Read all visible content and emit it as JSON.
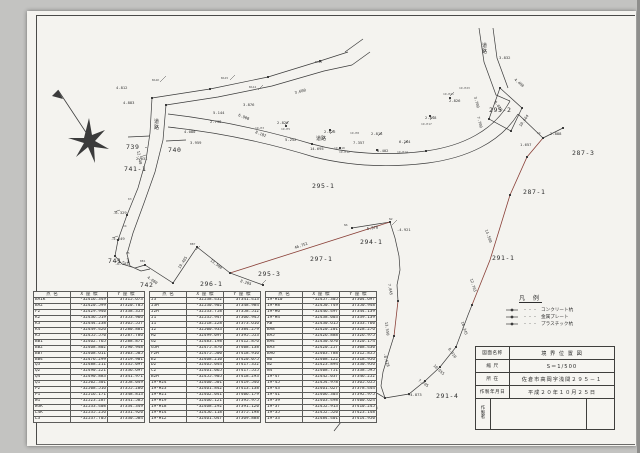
{
  "document": {
    "type": "scanned-survey-drawing",
    "colors": {
      "paper": "#f4f3ef",
      "line": "#3b3b3b",
      "red_boundary": "#8a4038",
      "scan_background": "#c3c3c1"
    }
  },
  "title_block": {
    "rows": [
      {
        "label": "図面名称",
        "value": "境 界 位 置 図"
      },
      {
        "label": "縮 尺",
        "value": "S＝1/500"
      },
      {
        "label": "所 在",
        "value": "佐倉市高岡字浅間２９５－１"
      },
      {
        "label": "作製年月日",
        "value": "平成２０年１０月２５日"
      }
    ],
    "maker_label": [
      "作",
      "製",
      "者"
    ],
    "maker_value": ""
  },
  "legend": {
    "title": "凡 例",
    "dots": "・・・",
    "items": [
      {
        "symbol": "concrete-pile-mark",
        "label": "コンクリート杭"
      },
      {
        "symbol": "metal-plate-mark",
        "label": "金属プレート"
      },
      {
        "symbol": "plastic-pile-mark",
        "label": "プラスチック杭"
      }
    ]
  },
  "tables": [
    {
      "headers": [
        "点 名",
        "X 座 標",
        "Y 座 標"
      ],
      "rows": [
        [
          "BA1K",
          "-32416.349",
          "37315.673"
        ],
        [
          "BA2",
          "-32420.599",
          "37320.705"
        ],
        [
          "F2",
          "-32429.940",
          "37338.353"
        ],
        [
          "K2",
          "-32436.519",
          "37353.966"
        ],
        [
          "K3",
          "-32444.238",
          "37365.557"
        ],
        [
          "K4",
          "-32449.426",
          "37280.881"
        ],
        [
          "K5",
          "-32455.570",
          "37287.786"
        ],
        [
          "BB1",
          "-32462.765",
          "37288.871"
        ],
        [
          "BB2",
          "-32468.802",
          "37290.948"
        ],
        [
          "BB7",
          "-32468.611",
          "37303.505"
        ],
        [
          "BB4",
          "-32476.299",
          "37319.901"
        ],
        [
          "Q3",
          "-32488.211",
          "37335.097"
        ],
        [
          "Q2",
          "-32490.221",
          "37336.697"
        ],
        [
          "Q4",
          "-32490.883",
          "37341.971"
        ],
        [
          "Q1",
          "-32502.301",
          "37358.049"
        ],
        [
          "P2",
          "-32508.516",
          "37355.286"
        ],
        [
          "P1",
          "-32516.171",
          "37348.813"
        ],
        [
          "W1",
          "-32523.287",
          "37341.585"
        ],
        [
          "W3K",
          "-32533.408",
          "37334.349"
        ],
        [
          "L4K",
          "-32535.256",
          "37331.920"
        ],
        [
          "L3",
          "-32537.705",
          "37330.584"
        ]
      ]
    },
    {
      "headers": [
        "点 名",
        "X 座 標",
        "Y 座 標"
      ],
      "rows": [
        [
          "J3",
          "-32538.432",
          "37341.413"
        ],
        [
          "J3H",
          "-32530.902",
          "37348.984"
        ],
        [
          "J2H",
          "-32533.758",
          "37358.512"
        ],
        [
          "J1",
          "-32535.947",
          "37366.945"
        ],
        [
          "I1",
          "-32518.228",
          "37373.616"
        ],
        [
          "I2",
          "-32500.933",
          "37384.279"
        ],
        [
          "H2",
          "-32499.097",
          "37395.553"
        ],
        [
          "G2",
          "-32483.198",
          "37412.876"
        ],
        [
          "G5H",
          "-32475.870",
          "37408.138"
        ],
        [
          "F2H",
          "-32475.500",
          "37418.916"
        ],
        [
          "E2",
          "-32468.210",
          "37420.075"
        ],
        [
          "D2",
          "-32465.044",
          "37417.352"
        ],
        [
          "C2",
          "-32461.065",
          "37417.555"
        ],
        [
          "B2H",
          "-32455.905",
          "37418.293"
        ],
        [
          "19-H24",
          "-32460.501",
          "37419.546"
        ],
        [
          "19-H23",
          "-32461.842",
          "37413.138"
        ],
        [
          "19-H21",
          "-32462.041",
          "37406.179"
        ],
        [
          "19-H19",
          "-32466.121",
          "37395.975"
        ],
        [
          "19-H18",
          "-32468.292",
          "37391.120"
        ],
        [
          "19-H14",
          "-32456.118",
          "37375.198"
        ],
        [
          "19-H12",
          "-32461.647",
          "37369.888"
        ]
      ]
    },
    {
      "headers": [
        "点 名",
        "X 座 標",
        "Y 座 標"
      ],
      "rows": [
        [
          "19-H10",
          "-32457.305",
          "37364.697"
        ],
        [
          "19-H8",
          "-32450.749",
          "37350.948"
        ],
        [
          "19-H6",
          "-32446.497",
          "37344.139"
        ],
        [
          "19-H4",
          "-32438.003",
          "37339.139"
        ],
        [
          "AB",
          "-32430.615",
          "37333.760"
        ],
        [
          "BA8",
          "-32420.201",
          "37328.276"
        ],
        [
          "BA5",
          "-32426.888",
          "37326.975"
        ],
        [
          "BA4",
          "-32430.070",
          "37320.174"
        ],
        [
          "BA3",
          "-32420.257",
          "37308.430"
        ],
        [
          "BA6",
          "-32403.788",
          "37312.855"
        ],
        [
          "N6",
          "-32408.122",
          "37318.956"
        ],
        [
          "N2",
          "-32423.894",
          "37330.956"
        ],
        [
          "N4",
          "-32408.751",
          "37338.595"
        ],
        [
          "19-47",
          "-32442.037",
          "37346.252"
        ],
        [
          "19-45",
          "-32454.978",
          "37365.655"
        ],
        [
          "19-43",
          "-32461.627",
          "37378.444"
        ],
        [
          "19-41",
          "-32466.303",
          "37392.975"
        ],
        [
          "19-39",
          "-32463.498",
          "37400.624"
        ],
        [
          "19-37",
          "-32452.913",
          "37410.245"
        ],
        [
          "19-35",
          "-32452.520",
          "37423.148"
        ],
        [
          "19-33",
          "-32484.401",
          "37414.950"
        ]
      ]
    }
  ],
  "map": {
    "labels": [
      {
        "t": "739 -",
        "x": 126,
        "y": 149,
        "c": "lp"
      },
      {
        "t": "740",
        "x": 168,
        "y": 152,
        "c": "lp"
      },
      {
        "t": "741-1",
        "x": 124,
        "y": 171,
        "c": "lp"
      },
      {
        "t": "741-1",
        "x": 108,
        "y": 263,
        "c": "lp"
      },
      {
        "t": "742",
        "x": 140,
        "y": 287,
        "c": "lp"
      },
      {
        "t": "296-1",
        "x": 200,
        "y": 286,
        "c": "lp"
      },
      {
        "t": "295-3",
        "x": 258,
        "y": 276,
        "c": "lp"
      },
      {
        "t": "297-1",
        "x": 310,
        "y": 261,
        "c": "lp"
      },
      {
        "t": "295-1",
        "x": 312,
        "y": 188,
        "c": "lp"
      },
      {
        "t": "294-1",
        "x": 360,
        "y": 244,
        "c": "lp"
      },
      {
        "t": "294-1",
        "x": 350,
        "y": 364,
        "c": "lp"
      },
      {
        "t": "293-6",
        "x": 346,
        "y": 409,
        "c": "lp"
      },
      {
        "t": "291-4",
        "x": 436,
        "y": 398,
        "c": "lp"
      },
      {
        "t": "291-1",
        "x": 492,
        "y": 260,
        "c": "lp"
      },
      {
        "t": "287-1",
        "x": 523,
        "y": 194,
        "c": "lp"
      },
      {
        "t": "287-3",
        "x": 572,
        "y": 155,
        "c": "lp"
      },
      {
        "t": "295-2",
        "x": 489,
        "y": 112,
        "c": "lp"
      },
      {
        "t": "4.812",
        "x": 116,
        "y": 89,
        "c": "ld"
      },
      {
        "t": "4.883",
        "x": 123,
        "y": 104,
        "c": "ld"
      },
      {
        "t": "2.031",
        "x": 136,
        "y": 160,
        "c": "ld"
      },
      {
        "t": "4.080",
        "x": 184,
        "y": 133,
        "c": "ld"
      },
      {
        "t": "3.959",
        "x": 190,
        "y": 144,
        "c": "ld"
      },
      {
        "t": "3.876",
        "x": 243,
        "y": 106,
        "c": "ld"
      },
      {
        "t": "5.144",
        "x": 213,
        "y": 114,
        "c": "ld"
      },
      {
        "t": "2.738",
        "x": 210,
        "y": 123,
        "c": "ld"
      },
      {
        "t": "3.600",
        "x": 295,
        "y": 94,
        "c": "ld",
        "r": -14
      },
      {
        "t": "6.908",
        "x": 238,
        "y": 116,
        "c": "ld",
        "r": 22
      },
      {
        "t": "8.182",
        "x": 255,
        "y": 133,
        "c": "ld",
        "r": 22
      },
      {
        "t": "2.826",
        "x": 277,
        "y": 124,
        "c": "ld"
      },
      {
        "t": "5.252",
        "x": 285,
        "y": 141,
        "c": "ld"
      },
      {
        "t": "2.826",
        "x": 324,
        "y": 133,
        "c": "ld"
      },
      {
        "t": "14.695",
        "x": 310,
        "y": 150,
        "c": "ld"
      },
      {
        "t": "7.357",
        "x": 353,
        "y": 144,
        "c": "ld"
      },
      {
        "t": "2.818",
        "x": 371,
        "y": 135,
        "c": "ld"
      },
      {
        "t": "8.402",
        "x": 377,
        "y": 152,
        "c": "ld"
      },
      {
        "t": "6.284",
        "x": 399,
        "y": 143,
        "c": "ld"
      },
      {
        "t": "2.826",
        "x": 449,
        "y": 102,
        "c": "ld"
      },
      {
        "t": "2.818",
        "x": 425,
        "y": 119,
        "c": "ld"
      },
      {
        "t": "3.832",
        "x": 499,
        "y": 59,
        "c": "ld"
      },
      {
        "t": "4.488",
        "x": 514,
        "y": 80,
        "c": "ld",
        "r": 40
      },
      {
        "t": "2.888",
        "x": 550,
        "y": 135,
        "c": "ld"
      },
      {
        "t": "1.657",
        "x": 520,
        "y": 146,
        "c": "ld"
      },
      {
        "t": "8.020",
        "x": 494,
        "y": 102,
        "c": "ld",
        "r": 55
      },
      {
        "t": "3.700",
        "x": 474,
        "y": 97,
        "c": "ld",
        "r": 75
      },
      {
        "t": "7.700",
        "x": 477,
        "y": 117,
        "c": "ld",
        "r": 75
      },
      {
        "t": "10.664",
        "x": 521,
        "y": 127,
        "c": "ld",
        "r": -55
      },
      {
        "t": "5.978",
        "x": 367,
        "y": 230,
        "c": "ld",
        "r": -8
      },
      {
        "t": "-4.921",
        "x": 397,
        "y": 231,
        "c": "ld"
      },
      {
        "t": "46.751",
        "x": 295,
        "y": 249,
        "c": "ld",
        "r": -19
      },
      {
        "t": "8.205",
        "x": 240,
        "y": 282,
        "c": "ld",
        "r": 17
      },
      {
        "t": "13.500",
        "x": 210,
        "y": 261,
        "c": "ld",
        "r": 37
      },
      {
        "t": "19.405",
        "x": 180,
        "y": 269,
        "c": "ld",
        "r": -57
      },
      {
        "t": "4.080",
        "x": 147,
        "y": 278,
        "c": "ld",
        "r": 35
      },
      {
        "t": "-6.329",
        "x": 113,
        "y": 214,
        "c": "ld"
      },
      {
        "t": "-5.649",
        "x": 111,
        "y": 240,
        "c": "ld"
      },
      {
        "t": "-6.183",
        "x": 115,
        "y": 265,
        "c": "ld"
      },
      {
        "t": "12.540",
        "x": 137,
        "y": 151,
        "c": "ld",
        "r": 80
      },
      {
        "t": "14.580",
        "x": 485,
        "y": 230,
        "c": "ld",
        "r": 70
      },
      {
        "t": "12.703",
        "x": 470,
        "y": 279,
        "c": "ld",
        "r": 73
      },
      {
        "t": "16.345",
        "x": 461,
        "y": 322,
        "c": "ld",
        "r": 72
      },
      {
        "t": "8.310",
        "x": 448,
        "y": 349,
        "c": "ld",
        "r": 55
      },
      {
        "t": "10.655",
        "x": 433,
        "y": 366,
        "c": "ld",
        "r": 43
      },
      {
        "t": "7.705",
        "x": 418,
        "y": 381,
        "c": "ld",
        "r": 33
      },
      {
        "t": "-4.873",
        "x": 408,
        "y": 396,
        "c": "ld"
      },
      {
        "t": "3.176",
        "x": 344,
        "y": 387,
        "c": "ld"
      },
      {
        "t": "-4.426",
        "x": 364,
        "y": 409,
        "c": "ld"
      },
      {
        "t": "11.856",
        "x": 370,
        "y": 377,
        "c": "ld",
        "r": 80
      },
      {
        "t": "-8.528",
        "x": 383,
        "y": 354,
        "c": "ld",
        "r": 72
      },
      {
        "t": "13.550",
        "x": 385,
        "y": 322,
        "c": "ld",
        "r": 83
      },
      {
        "t": "7.845",
        "x": 388,
        "y": 284,
        "c": "ld",
        "r": 80
      },
      {
        "t": "BA1K",
        "x": 152,
        "y": 81,
        "c": "lpt"
      },
      {
        "t": "BA15",
        "x": 221,
        "y": 79,
        "c": "lpt"
      },
      {
        "t": "BA14",
        "x": 249,
        "y": 88,
        "c": "lpt"
      },
      {
        "t": "BA12",
        "x": 315,
        "y": 63,
        "c": "lpt"
      },
      {
        "t": "19-H3",
        "x": 255,
        "y": 129,
        "c": "lpt"
      },
      {
        "t": "19-H5",
        "x": 281,
        "y": 130,
        "c": "lpt"
      },
      {
        "t": "19-H8",
        "x": 350,
        "y": 134,
        "c": "lpt"
      },
      {
        "t": "19-H10",
        "x": 334,
        "y": 149,
        "c": "lpt"
      },
      {
        "t": "19-H12",
        "x": 339,
        "y": 153,
        "c": "lpt"
      },
      {
        "t": "19-H14",
        "x": 397,
        "y": 153,
        "c": "lpt"
      },
      {
        "t": "19-H17",
        "x": 421,
        "y": 125,
        "c": "lpt"
      },
      {
        "t": "19-H21",
        "x": 443,
        "y": 95,
        "c": "lpt"
      },
      {
        "t": "19-H23",
        "x": 459,
        "y": 89,
        "c": "lpt"
      },
      {
        "t": "K3",
        "x": 128,
        "y": 200,
        "c": "lpt"
      },
      {
        "t": "K4",
        "x": 123,
        "y": 227,
        "c": "lpt"
      },
      {
        "t": "K5",
        "x": 126,
        "y": 254,
        "c": "lpt"
      },
      {
        "t": "BB1",
        "x": 140,
        "y": 262,
        "c": "lpt"
      },
      {
        "t": "BB2",
        "x": 163,
        "y": 300,
        "c": "lpt"
      },
      {
        "t": "BB7",
        "x": 190,
        "y": 245,
        "c": "lpt"
      },
      {
        "t": "N2",
        "x": 389,
        "y": 220,
        "c": "lpt"
      },
      {
        "t": "N6",
        "x": 344,
        "y": 226,
        "c": "lpt"
      },
      {
        "t": "A4",
        "x": 537,
        "y": 134,
        "c": "lpt"
      },
      {
        "t": "道",
        "x": 154,
        "y": 123,
        "c": "lr"
      },
      {
        "t": "路",
        "x": 154,
        "y": 129,
        "c": "lr"
      },
      {
        "t": "道路",
        "x": 316,
        "y": 140,
        "c": "lr"
      },
      {
        "t": "道",
        "x": 482,
        "y": 47,
        "c": "lr"
      },
      {
        "t": "路",
        "x": 482,
        "y": 53,
        "c": "lr"
      }
    ]
  }
}
